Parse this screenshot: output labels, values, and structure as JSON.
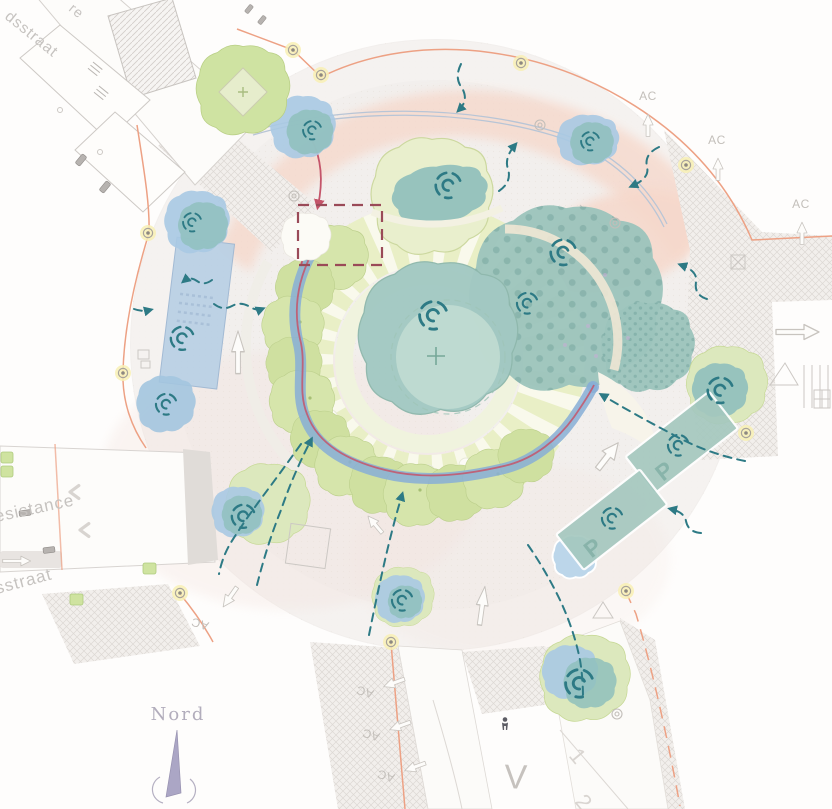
{
  "labels": {
    "ac": "AC",
    "parking": "P",
    "v": "V",
    "lane_1": "1",
    "lane_2": "2"
  },
  "streets": {
    "top_left_fragment": "re",
    "top_left": "dsstraat",
    "left_upper": "esistance",
    "left_lower": "sstraat"
  },
  "compass": {
    "north_label": "Nord"
  },
  "colors": {
    "flow_teal": "#2d7a85",
    "route_red": "#c4556a",
    "focus_square_red": "#9a4a58",
    "water_blue": "#87aed6",
    "basin_blue": "#b9d0e5",
    "canopy_teal": "#9cc4bc",
    "tree_green": "#d6e5ab",
    "paving_pink": "#f6d8cb",
    "boundary_orange": "#eda184",
    "lamp_yellow": "#f8f0b4",
    "parking_teal": "#a5c8bf",
    "compass_purple": "#a39dc0",
    "street_text_gray": "#c6c3c0"
  }
}
